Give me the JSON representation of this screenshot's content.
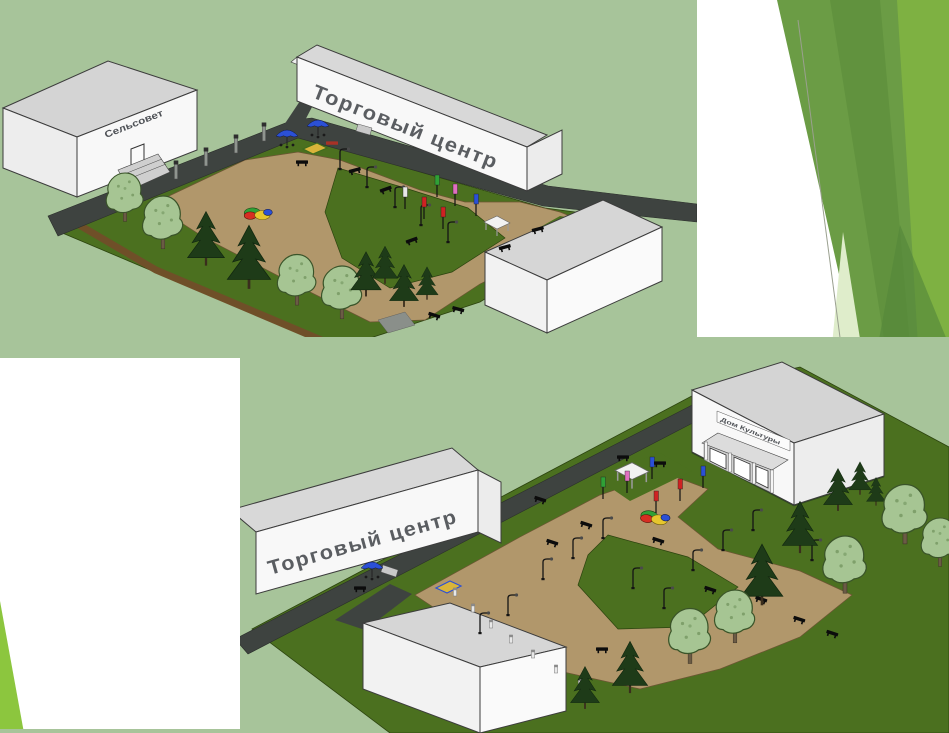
{
  "slide": {
    "kind": "presentation-slide",
    "background": "#FFFFFF",
    "palette": {
      "render_sky": "#A7C49A",
      "leaf_bright": "#7EB142",
      "leaf_mid": "#6B9C45",
      "leaf_dark": "#5E8F3C",
      "leaf_pale": "#DFEDCB",
      "leaf_lime": "#8CC63E",
      "road": "#3E4340",
      "grass": "#4B701F",
      "plaza_sand": "#B1976B",
      "building_face": "#F7F7F7",
      "building_roof": "#D6D6D6"
    }
  },
  "top_render": {
    "building_labels": {
      "village_council": "Сельсовет",
      "shopping_center": "Торговый центр"
    }
  },
  "bottom_render": {
    "building_labels": {
      "shopping_center": "Торговый центр",
      "culture_house": "Дом Культуры"
    }
  }
}
